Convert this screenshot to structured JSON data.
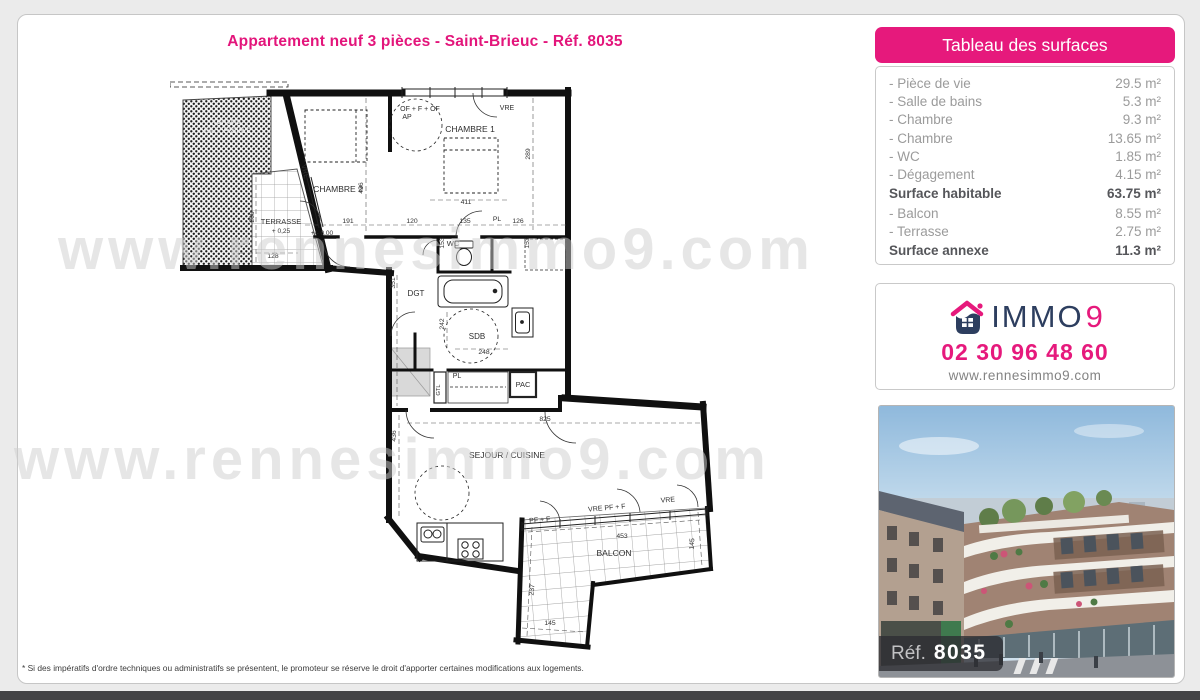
{
  "page": {
    "title": "Appartement neuf 3 pièces - Saint-Brieuc - Réf. 8035",
    "watermark": "www.rennesimmo9.com",
    "footnote": "* Si des impératifs d'ordre techniques ou administratifs se présentent, le promoteur se réserve le droit d'apporter certaines modifications aux logements."
  },
  "surfaces_panel": {
    "title": "Tableau des surfaces",
    "rows": [
      {
        "label": "- Pièce de vie",
        "value": "29.5 m²"
      },
      {
        "label": "- Salle de bains",
        "value": "5.3 m²"
      },
      {
        "label": "- Chambre",
        "value": "9.3 m²"
      },
      {
        "label": "- Chambre",
        "value": "13.65 m²"
      },
      {
        "label": "- WC",
        "value": "1.85 m²"
      },
      {
        "label": "- Dégagement",
        "value": "4.15 m²"
      },
      {
        "label": "Surface habitable",
        "value": "63.75 m²"
      },
      {
        "label": "- Balcon",
        "value": "8.55 m²"
      },
      {
        "label": "- Terrasse",
        "value": "2.75 m²"
      },
      {
        "label": "Surface annexe",
        "value": "11.3 m²"
      }
    ]
  },
  "contact_panel": {
    "brand_immo": "IMMO",
    "brand_9": "9",
    "phone": "02 30 96 48 60",
    "website": "www.rennesimmo9.com"
  },
  "photo_panel": {
    "ref_label": "Réf.",
    "ref_number": "8035"
  },
  "colors": {
    "pink": "#e6197c",
    "navy": "#2d3e5f",
    "label_gray": "#9b9b9b",
    "bold_gray": "#55565a"
  },
  "floor_plan": {
    "labels": {
      "roof_line1": "TOITURE",
      "roof_line2": "INACCESSIBLE",
      "terrasse": "TERRASSE",
      "terrasse_level": "+ 0,25",
      "chambre2": "CHAMBRE 2",
      "chambre1": "CHAMBRE 1",
      "entry_level": "+/- 0,00",
      "wc": "WC",
      "dgt": "DGT",
      "sdb": "SDB",
      "gtl": "GTL",
      "pac": "PAC",
      "pl_corridor": "PL",
      "pl_closet": "PL",
      "sejour": "SEJOUR / CUISINE",
      "balcon": "BALCON",
      "of_af": "OF + F + OF",
      "ap": "AP",
      "vre_slant": "VRE",
      "vre_top": "VRE",
      "vre_balcony": "VRE",
      "pf_f": "PF + F",
      "vre_pf_f": "VRE  PF + F"
    },
    "dims": {
      "d289": "289",
      "d436_chambre": "436",
      "d411": "411",
      "d191": "191",
      "d120": "120",
      "d135": "135",
      "d126": "126",
      "d153_left": "153",
      "d153_right": "153",
      "d260": "260",
      "d128": "128",
      "d351": "351",
      "d242": "242",
      "d248": "248",
      "d825": "825",
      "d436_sejour": "436",
      "d453": "453",
      "d145_right": "145",
      "d237": "237",
      "d145_bottom": "145"
    }
  }
}
